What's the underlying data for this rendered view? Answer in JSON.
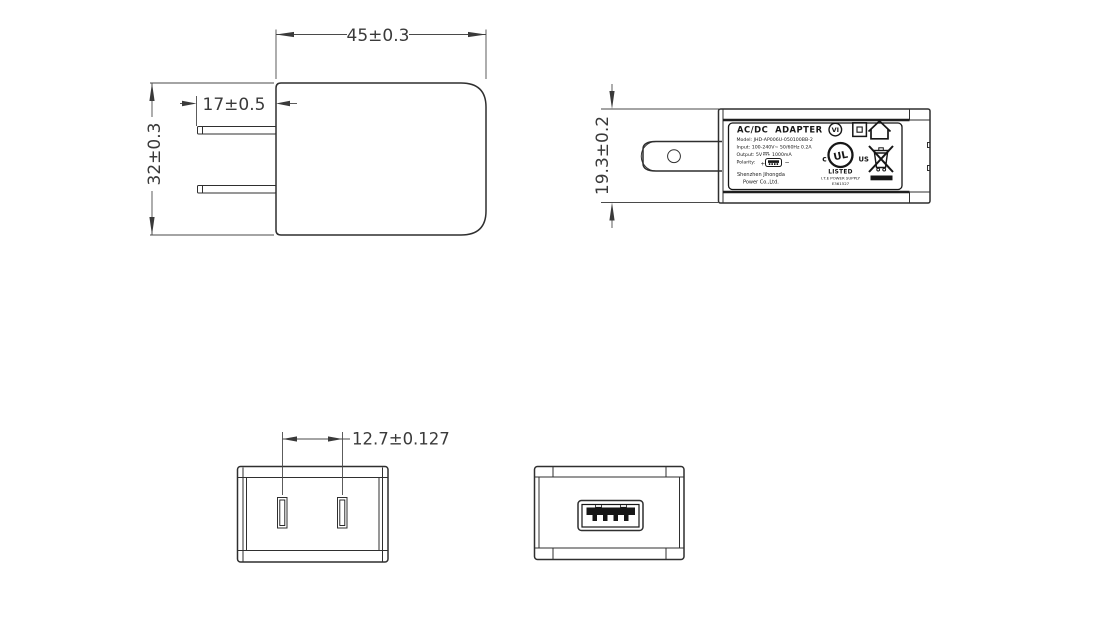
{
  "page": {
    "title": "AC/DC adapter technical drawing",
    "background": "#ffffff",
    "line_color": "#2f2f2f",
    "text_color": "#3a3a3a"
  },
  "views": {
    "front": {
      "name": "front-view",
      "dim_width": "45±0.3",
      "dim_pin_length": "17±0.5",
      "dim_height": "32±0.3"
    },
    "top": {
      "name": "top-view-with-label",
      "dim_thickness": "19.3±0.2"
    },
    "plug_face": {
      "name": "plug-face-view",
      "dim_pin_spacing": "12.7±0.127"
    },
    "usb_face": {
      "name": "usb-output-face-view"
    }
  },
  "label": {
    "title": "AC/DC  ADAPTER",
    "model": "Model: JHD-AP006U-050100BB-2",
    "input": "Input: 100-240V~ 50/60Hz 0.2A",
    "output_prefix": "Output: 5V",
    "output_suffix": "1000mA",
    "polarity": "Polarity:",
    "plus": "+",
    "minus": "−",
    "company_line1": "Shenzhen Jihongda",
    "company_line2": "Power Co.,Ltd.",
    "marks": {
      "efficiency": "VI",
      "ul_monogram": "UL",
      "ul_c": "c",
      "ul_us": "US",
      "listed": "LISTED",
      "ite": "I.T.E POWER SUPPLY",
      "file_no": "E361527"
    }
  }
}
